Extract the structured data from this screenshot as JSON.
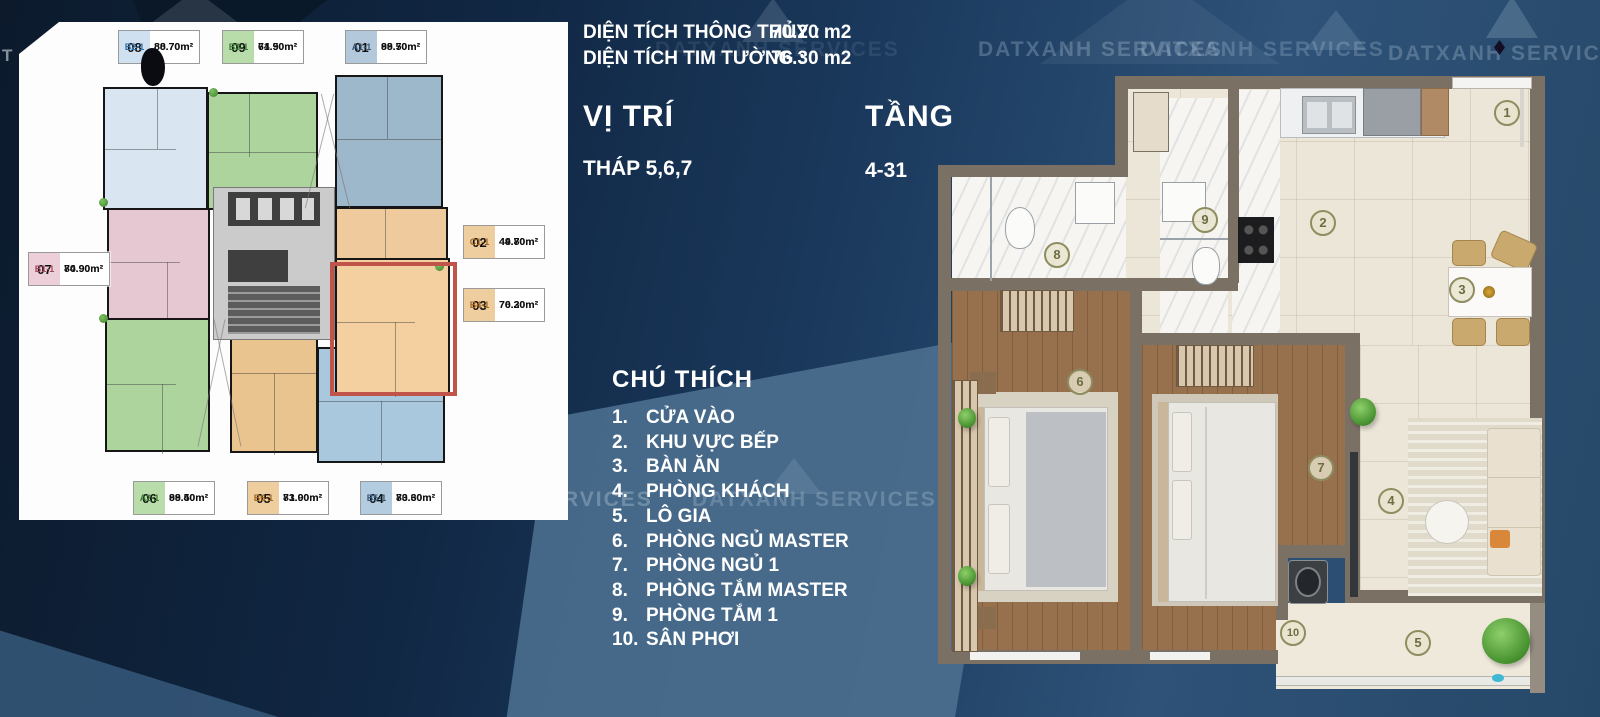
{
  "brand": {
    "watermark": "DATXANH SERVICES",
    "watermark_fragment": "T"
  },
  "info": {
    "area_net_label": "DIỆN TÍCH THÔNG THỦY :",
    "area_net_value": "70.20 m2",
    "area_gross_label": "DIỆN TÍCH TIM TƯỜNG :",
    "area_gross_value": "76.30 m2",
    "position_label": "VỊ TRÍ",
    "position_value": "THÁP 5,6,7",
    "floor_label": "TẦNG",
    "floor_value": "4-31"
  },
  "legend": {
    "title": "CHÚ THÍCH",
    "items": [
      {
        "no": "1.",
        "label": "CỬA VÀO"
      },
      {
        "no": "2.",
        "label": "KHU VỰC BẾP"
      },
      {
        "no": "3.",
        "label": "BÀN ĂN"
      },
      {
        "no": "4.",
        "label": "PHÒNG KHÁCH"
      },
      {
        "no": "5.",
        "label": "LÔ GIA"
      },
      {
        "no": "6.",
        "label": "PHÒNG NGỦ MASTER"
      },
      {
        "no": "7.",
        "label": "PHÒNG NGỦ 1"
      },
      {
        "no": "8.",
        "label": "PHÒNG TẮM MASTER"
      },
      {
        "no": "9.",
        "label": "PHÒNG TẮM 1"
      },
      {
        "no": "10.",
        "label": "SÂN PHƠI"
      }
    ]
  },
  "floorplate": {
    "highlight_color": "#c0544a",
    "units": [
      {
        "num": "08",
        "code": "B2-1",
        "area1": "88.70m²",
        "area2": "80.70m²",
        "color": "#cfe0f0",
        "code_color": "#2f6fa8",
        "fill": "#d9e6f2"
      },
      {
        "num": "09",
        "code": "B3-1",
        "area1": "71.50m²",
        "area2": "64.90m²",
        "color": "#b9dcab",
        "code_color": "#3c7d35",
        "fill": "#aed49d"
      },
      {
        "num": "01",
        "code": "A1-1",
        "area1": "98.50m²",
        "area2": "89.70m²",
        "color": "#b3c8da",
        "code_color": "#38597a",
        "fill": "#9db7cb"
      },
      {
        "num": "07",
        "code": "B1-1",
        "area1": "80.90m²",
        "area2": "74.90m²",
        "color": "#eccfd8",
        "code_color": "#a04a5e",
        "fill": "#e6c8d2"
      },
      {
        "num": "02",
        "code": "C1-1",
        "area1": "49.80m²",
        "area2": "44.70m²",
        "color": "#eecd9e",
        "code_color": "#a5691e",
        "fill": "#efca9c"
      },
      {
        "num": "03",
        "code": "B4-1",
        "area1": "76.30m²",
        "area2": "70.20m²",
        "color": "#eecd9e",
        "code_color": "#a5691e",
        "fill": "#f4d0a0"
      },
      {
        "num": "06",
        "code": "A2-1",
        "area1": "98.50m²",
        "area2": "89.40m²",
        "color": "#b9dcab",
        "code_color": "#3c7d35",
        "fill": "#aed49d"
      },
      {
        "num": "05",
        "code": "B6-1",
        "area1": "81.00m²",
        "area2": "73.90m²",
        "color": "#eecd9e",
        "code_color": "#a5691e",
        "fill": "#eac48e"
      },
      {
        "num": "04",
        "code": "B5-1",
        "area1": "80.60m²",
        "area2": "73.30m²",
        "color": "#b3cce0",
        "code_color": "#38597a",
        "fill": "#a9c7dd"
      }
    ]
  },
  "plan": {
    "markers": [
      "1",
      "2",
      "3",
      "4",
      "5",
      "6",
      "7",
      "8",
      "9",
      "10"
    ]
  }
}
